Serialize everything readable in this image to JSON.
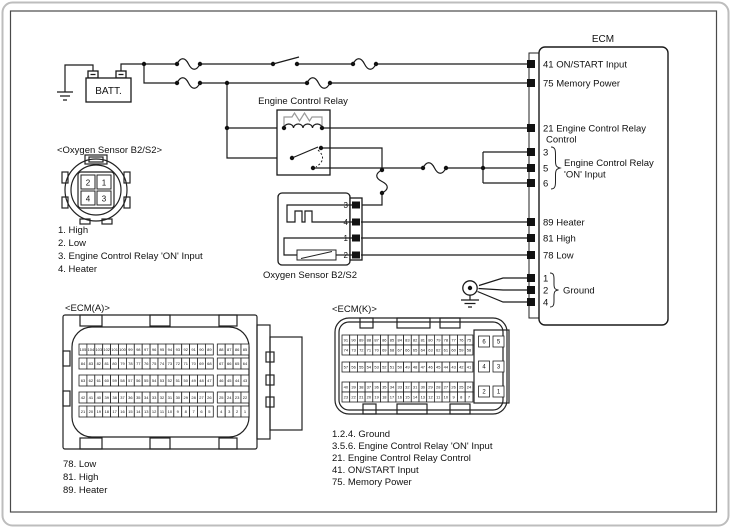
{
  "battery": {
    "label": "BATT."
  },
  "relay": {
    "label": "Engine Control Relay"
  },
  "ecm": {
    "title": "ECM",
    "pin41": "41 ON/START Input",
    "pin75": "75 Memory Power",
    "pin21_line1": "21 Engine Control Relay",
    "pin21_line2": "Control",
    "pin3": "3",
    "pin5": "5",
    "pin6": "6",
    "group356_line1": "Engine Control Relay",
    "group356_line2": "'ON' Input",
    "pin89": "89 Heater",
    "pin81": "81 High",
    "pin78": "78 Low",
    "pin1": "1",
    "pin2": "2",
    "pin4": "4",
    "group124": "Ground"
  },
  "o2_connector": {
    "label": "<Oxygen Sensor B2/S2>",
    "pins": [
      "2",
      "1",
      "4",
      "3"
    ],
    "legend": [
      "1. High",
      "2. Low",
      "3. Engine Control Relay 'ON' Input",
      "4. Heater"
    ]
  },
  "o2_component": {
    "label": "Oxygen Sensor B2/S2",
    "pins": [
      "3",
      "4",
      "1",
      "2"
    ]
  },
  "ecm_a": {
    "label": "<ECM(A)>",
    "rows": [
      [
        105,
        104,
        103,
        102,
        101,
        100,
        99,
        98,
        97,
        96,
        95,
        94,
        93,
        92,
        91,
        90,
        89,
        88,
        87,
        86,
        85
      ],
      [
        84,
        83,
        82,
        81,
        80,
        79,
        78,
        77,
        76,
        75,
        74,
        73,
        72,
        71,
        70,
        69,
        68,
        67,
        66,
        65,
        64
      ],
      [
        63,
        62,
        61,
        60,
        59,
        58,
        57,
        56,
        55,
        54,
        53,
        52,
        51,
        50,
        49,
        48,
        47,
        46,
        45,
        44,
        43
      ],
      [
        42,
        41,
        40,
        39,
        38,
        37,
        36,
        35,
        34,
        33,
        32,
        31,
        30,
        29,
        28,
        27,
        26,
        25,
        24,
        23,
        22
      ],
      [
        21,
        20,
        19,
        18,
        17,
        16,
        15,
        14,
        13,
        12,
        11,
        10,
        9,
        8,
        7,
        6,
        5,
        4,
        3,
        2,
        1
      ]
    ],
    "legend": [
      "78. Low",
      "81. High",
      "89. Heater"
    ]
  },
  "ecm_k": {
    "label": "<ECM(K)>",
    "rows": [
      [
        91,
        90,
        89,
        88,
        87,
        86,
        85,
        84,
        83,
        82,
        81,
        80,
        79,
        78,
        77,
        76,
        75
      ],
      [
        74,
        73,
        72,
        71,
        70,
        69,
        68,
        67,
        66,
        65,
        64,
        63,
        62,
        61,
        60,
        59,
        58
      ],
      [
        57,
        56,
        55,
        54,
        53,
        52,
        51,
        50,
        49,
        48,
        47,
        46,
        45,
        44,
        43,
        42,
        41
      ],
      [
        40,
        39,
        38,
        37,
        36,
        35,
        34,
        33,
        32,
        31,
        30,
        29,
        28,
        27,
        26,
        25,
        24
      ],
      [
        23,
        22,
        21,
        20,
        19,
        18,
        17,
        16,
        15,
        14,
        13,
        12,
        11,
        10,
        9,
        8,
        7
      ]
    ],
    "big_pins": [
      [
        "6",
        "5"
      ],
      [
        "4",
        "3"
      ],
      [
        "2",
        "1"
      ]
    ],
    "legend": [
      "1.2.4. Ground",
      "3.5.6. Engine Control Relay 'ON' Input",
      "21. Engine Control Relay Control",
      "41. ON/START Input",
      "75. Memory Power"
    ]
  }
}
